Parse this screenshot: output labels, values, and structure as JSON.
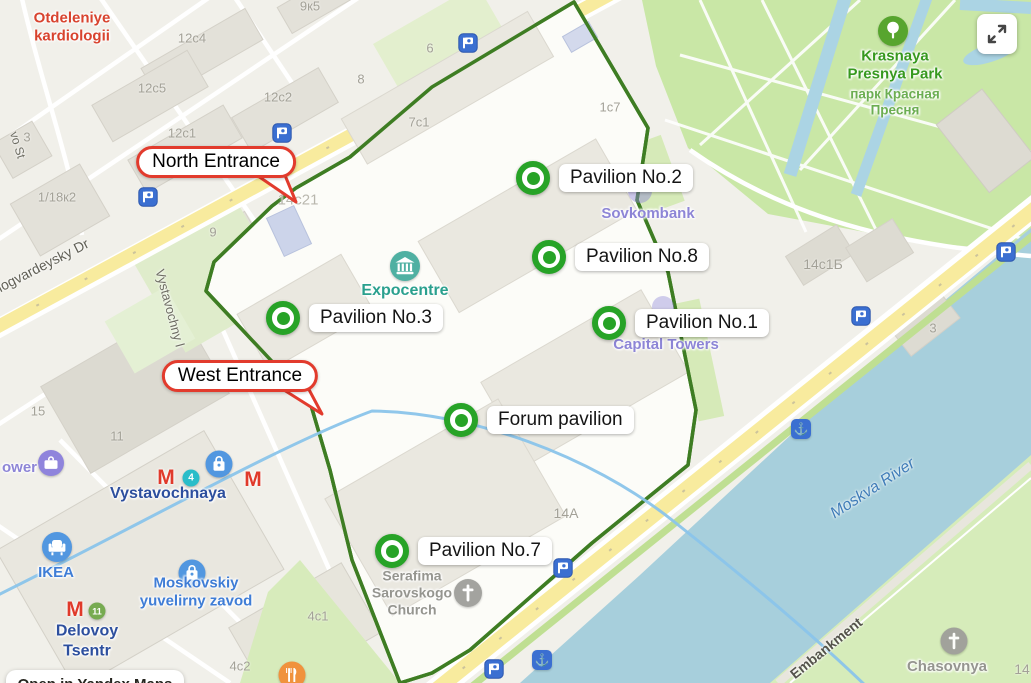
{
  "attribution": {
    "label": "Open in Yandex Maps"
  },
  "callouts": {
    "north": "North Entrance",
    "west": "West Entrance"
  },
  "pavilions": [
    {
      "label": "Pavilion No.2"
    },
    {
      "label": "Pavilion No.8"
    },
    {
      "label": "Pavilion No.3"
    },
    {
      "label": "Pavilion No.1"
    },
    {
      "label": "Forum pavilion"
    },
    {
      "label": "Pavilion No.7"
    }
  ],
  "poi": {
    "otdeleniye": "Otdeleniye\nkardiologii",
    "krasnaya_presnya_en": "Krasnaya\nPresnya Park",
    "krasnaya_presnya_ru": "парк Красная\nПресня",
    "expocentre": "Expocentre",
    "sovkombank": "Sovkombank",
    "capital_towers": "Capital Towers",
    "tower_partial": "ower",
    "vystavochnaya": "Vystavochnaya",
    "ikea": "IKEA",
    "moskovskiy": "Moskovskiy\nyuvelirny zavod",
    "delovoy": "Delovoy\nTsentr",
    "serafima": "Serafima\nSarovskogo\nChurch",
    "chasovnya": "Chasovnya"
  },
  "streets": {
    "krasnogvardeysky": "nogvardeysky Dr",
    "vo_st": "vo St",
    "vystavochny": "Vystavochny l",
    "embankment": "Embankment",
    "moskva_river": "Moskva River"
  },
  "building_numbers": [
    "12c4",
    "12c5",
    "12c2",
    "12c1",
    "9к5",
    "3",
    "1/18к2",
    "9",
    "14c21",
    "6",
    "8",
    "7c1",
    "1c7",
    "15",
    "11",
    "14A",
    "4c1",
    "4c2",
    "14c1Б",
    "3",
    "14"
  ],
  "badges": {
    "line4": "4",
    "line11": "11",
    "metro_m": "М",
    "anchor": "⚓"
  },
  "icons": {
    "expand": "expand-arrows",
    "tree": "park-tree",
    "museum": "expocentre-museum",
    "bus": "bus-stop",
    "anchor": "river-pier",
    "bag": "shopping",
    "armchair": "furniture-store",
    "briefcase": "business-center",
    "cross": "church",
    "fork-knife": "restaurant"
  },
  "colors": {
    "marker_green": "#27a327",
    "callout_red": "#e23b2d",
    "boundary_green": "#3e7d23",
    "park_green": "#c9e7a6",
    "river_blue": "#a7cfdc",
    "road_yellow": "#f8eb9e",
    "metro_line_blue": "#8ac4ea",
    "poi_blue": "#3f7dd6",
    "metro_text_blue": "#2d4f9e",
    "purple": "#8d85d6",
    "teal": "#2aa08e",
    "red_text": "#d8432e",
    "icon_blue": "#3b6fd1",
    "icon_orange": "#f0923d"
  }
}
